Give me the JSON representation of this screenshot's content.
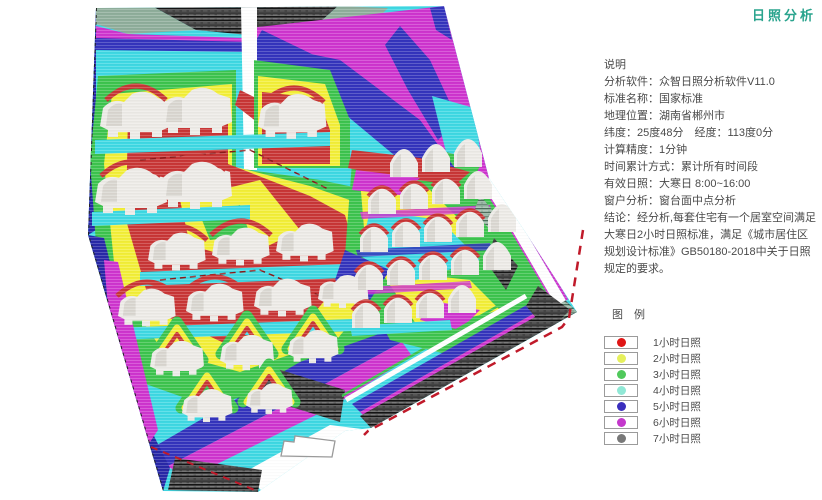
{
  "page": {
    "title": "日照分析",
    "title_color": "#2aa48e",
    "background": "#ffffff"
  },
  "notes": {
    "heading": "说明",
    "lines": [
      "分析软件：众智日照分析软件V11.0",
      "标准名称：国家标准",
      "地理位置：湖南省郴州市",
      "纬度：25度48分　经度：113度0分",
      "计算精度：1分钟",
      "时间累计方式：累计所有时间段",
      "有效日照：大寒日 8:00~16:00",
      "窗户分析：窗台面中点分析",
      "结论：经分析,每套住宅有一个居室空间满足大寒日2小时日照标准，满足《城市居住区规划设计标准》GB50180-2018中关于日照规定的要求。"
    ]
  },
  "legend": {
    "heading": "图 例",
    "items": [
      {
        "label": "1小时日照",
        "color": "#e01616"
      },
      {
        "label": "2小时日照",
        "color": "#e6f05c"
      },
      {
        "label": "3小时日照",
        "color": "#50c95c"
      },
      {
        "label": "4小时日照",
        "color": "#90e8d6"
      },
      {
        "label": "5小时日照",
        "color": "#3a2ebd"
      },
      {
        "label": "6小时日照",
        "color": "#c438cc"
      },
      {
        "label": "7小时日照",
        "color": "#787878"
      }
    ]
  },
  "map": {
    "palette": {
      "map-red": "#c93636",
      "map-yellow": "#f3ef38",
      "map-green": "#3dc44e",
      "map-cyan": "#3fd9e4",
      "map-blue": "#3434bd",
      "map-darkblue": "#2828a8",
      "map-magenta": "#cf35cf",
      "map-graygreen": "#8fae9b",
      "map-hatch": "#454545",
      "map-building": "#edebe7",
      "map-building-shade": "#d6d3cd",
      "map-boundary-red": "#c01a2a"
    }
  }
}
